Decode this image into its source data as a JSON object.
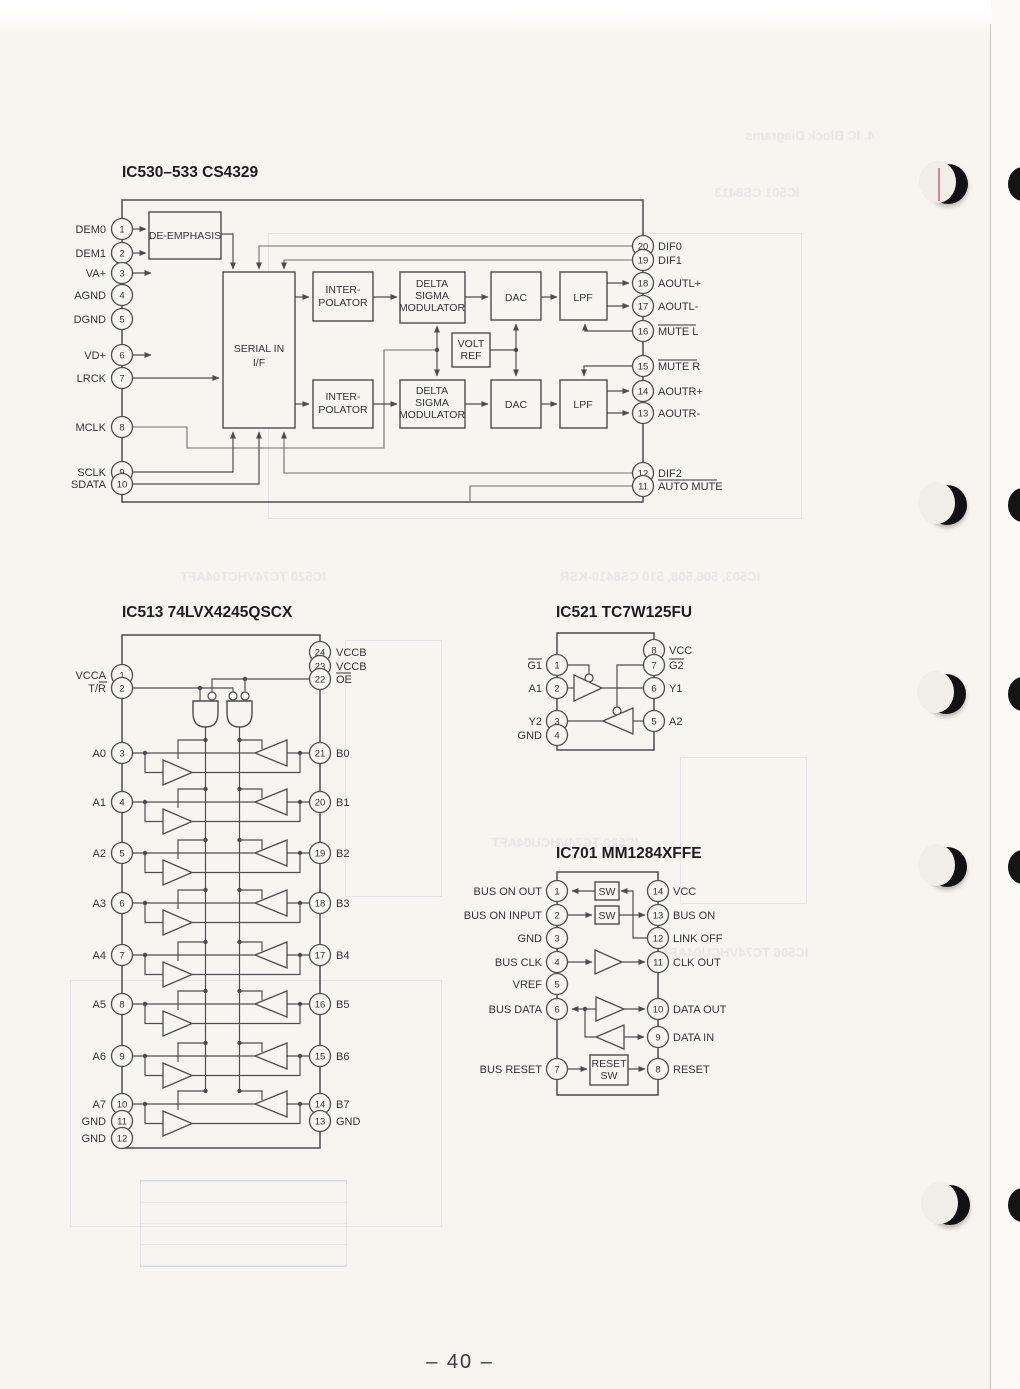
{
  "page": {
    "number": "– 40 –"
  },
  "ghost": {
    "top_right_1": "4. IC Block Diagrams",
    "top_right_2": "IC501 CS8413",
    "mid_left": "IC520 TC74VHCT04AFT",
    "mid_right": "IC503, 506,508, 510 CS8410-KSR",
    "above_ic701": "IC520 TC74VHCU04AFT",
    "right_mid": "IC506 TC74VHCU04AFT"
  },
  "ic530": {
    "title": "IC530–533  CS4329",
    "blocks": {
      "de": "DE-EMPHASIS",
      "ser1": "SERIAL IN",
      "ser2": "I/F",
      "int1": "INTER-",
      "int2": "POLATOR",
      "dsm1": "DELTA",
      "dsm2": "SIGMA",
      "dsm3": "MODULATOR",
      "dac": "DAC",
      "lpf": "LPF",
      "vr1": "VOLT",
      "vr2": "REF"
    },
    "left": [
      {
        "n": "1",
        "l": "DEM0"
      },
      {
        "n": "2",
        "l": "DEM1"
      },
      {
        "n": "3",
        "l": "VA+"
      },
      {
        "n": "4",
        "l": "AGND"
      },
      {
        "n": "5",
        "l": "DGND"
      },
      {
        "n": "6",
        "l": "VD+"
      },
      {
        "n": "7",
        "l": "LRCK"
      },
      {
        "n": "8",
        "l": "MCLK"
      },
      {
        "n": "9",
        "l": "SCLK"
      },
      {
        "n": "10",
        "l": "SDATA"
      }
    ],
    "right": [
      {
        "n": "20",
        "l": "DIF0"
      },
      {
        "n": "19",
        "l": "DIF1"
      },
      {
        "n": "18",
        "l": "AOUTL+"
      },
      {
        "n": "17",
        "l": "AOUTL-"
      },
      {
        "n": "16",
        "l": "MUTE L"
      },
      {
        "n": "15",
        "l": "MUTE R"
      },
      {
        "n": "14",
        "l": "AOUTR+"
      },
      {
        "n": "13",
        "l": "AOUTR-"
      },
      {
        "n": "12",
        "l": "DIF2"
      },
      {
        "n": "11",
        "l": "AUTO MUTE"
      }
    ]
  },
  "ic513": {
    "title": "IC513  74LVX4245QSCX",
    "tr_prefix": "T/",
    "tr_bar": "R",
    "left": [
      {
        "n": "1",
        "l": "VCCA"
      },
      {
        "n": "2",
        "l": ""
      },
      {
        "n": "3",
        "l": "A0"
      },
      {
        "n": "4",
        "l": "A1"
      },
      {
        "n": "5",
        "l": "A2"
      },
      {
        "n": "6",
        "l": "A3"
      },
      {
        "n": "7",
        "l": "A4"
      },
      {
        "n": "8",
        "l": "A5"
      },
      {
        "n": "9",
        "l": "A6"
      },
      {
        "n": "10",
        "l": "A7"
      },
      {
        "n": "11",
        "l": "GND"
      },
      {
        "n": "12",
        "l": "GND"
      }
    ],
    "right": [
      {
        "n": "24",
        "l": "VCCB"
      },
      {
        "n": "23",
        "l": "VCCB"
      },
      {
        "n": "22",
        "l": "OE"
      },
      {
        "n": "21",
        "l": "B0"
      },
      {
        "n": "20",
        "l": "B1"
      },
      {
        "n": "19",
        "l": "B2"
      },
      {
        "n": "18",
        "l": "B3"
      },
      {
        "n": "17",
        "l": "B4"
      },
      {
        "n": "16",
        "l": "B5"
      },
      {
        "n": "15",
        "l": "B6"
      },
      {
        "n": "14",
        "l": "B7"
      },
      {
        "n": "13",
        "l": "GND"
      }
    ]
  },
  "ic521": {
    "title": "IC521  TC7W125FU",
    "left": [
      {
        "n": "1",
        "l": "G1"
      },
      {
        "n": "2",
        "l": "A1"
      },
      {
        "n": "3",
        "l": "Y2"
      },
      {
        "n": "4",
        "l": "GND"
      }
    ],
    "right": [
      {
        "n": "8",
        "l": "VCC"
      },
      {
        "n": "7",
        "l": "G2"
      },
      {
        "n": "6",
        "l": "Y1"
      },
      {
        "n": "5",
        "l": "A2"
      }
    ]
  },
  "ic701": {
    "title": "IC701  MM1284XFFE",
    "blocks": {
      "sw": "SW",
      "rs1": "RESET",
      "rs2": "SW"
    },
    "left": [
      {
        "n": "1",
        "l": "BUS ON OUT"
      },
      {
        "n": "2",
        "l": "BUS ON INPUT"
      },
      {
        "n": "3",
        "l": "GND"
      },
      {
        "n": "4",
        "l": "BUS CLK"
      },
      {
        "n": "5",
        "l": "VREF"
      },
      {
        "n": "6",
        "l": "BUS DATA"
      },
      {
        "n": "7",
        "l": "BUS RESET"
      }
    ],
    "right": [
      {
        "n": "14",
        "l": "VCC"
      },
      {
        "n": "13",
        "l": "BUS ON"
      },
      {
        "n": "12",
        "l": "LINK OFF"
      },
      {
        "n": "11",
        "l": "CLK OUT"
      },
      {
        "n": "10",
        "l": "DATA OUT"
      },
      {
        "n": "9",
        "l": "DATA IN"
      },
      {
        "n": "8",
        "l": "RESET"
      }
    ]
  }
}
